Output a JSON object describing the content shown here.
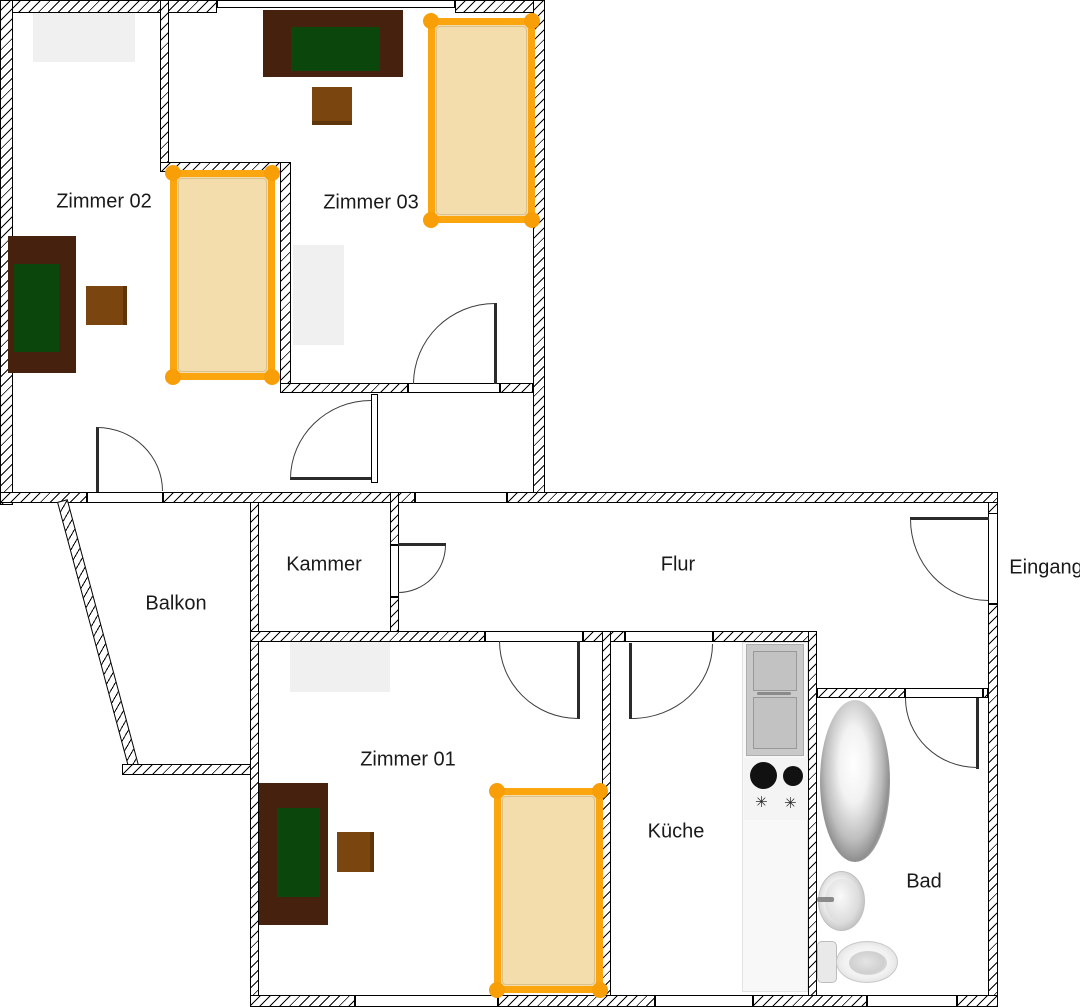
{
  "rooms": [
    {
      "id": "zimmer02",
      "label": "Zimmer 02"
    },
    {
      "id": "zimmer03",
      "label": "Zimmer 03"
    },
    {
      "id": "kammer",
      "label": "Kammer"
    },
    {
      "id": "balkon",
      "label": "Balkon"
    },
    {
      "id": "flur",
      "label": "Flur"
    },
    {
      "id": "eingang",
      "label": "Eingang"
    },
    {
      "id": "zimmer01",
      "label": "Zimmer 01"
    },
    {
      "id": "kueche",
      "label": "Küche"
    },
    {
      "id": "bad",
      "label": "Bad"
    }
  ],
  "kitchen": {
    "burner_symbol": "✳"
  },
  "fixtures": [
    "bed",
    "desk",
    "chair",
    "wardrobe",
    "door",
    "window",
    "refrigerator",
    "cooktop",
    "counter",
    "bathtub",
    "sink",
    "toilet"
  ],
  "colors": {
    "wall_line": "#000000",
    "bed_frame": "#fba50f",
    "bed_post": "#f89e06",
    "bed_mattress": "#f3ddac",
    "desk_body": "#46220e",
    "desk_top": "#0b470c",
    "chair": "#7a450f",
    "wardrobe": "#f0f0f0",
    "appliance_gray": "#c9c9c9",
    "burner": "#111111"
  }
}
